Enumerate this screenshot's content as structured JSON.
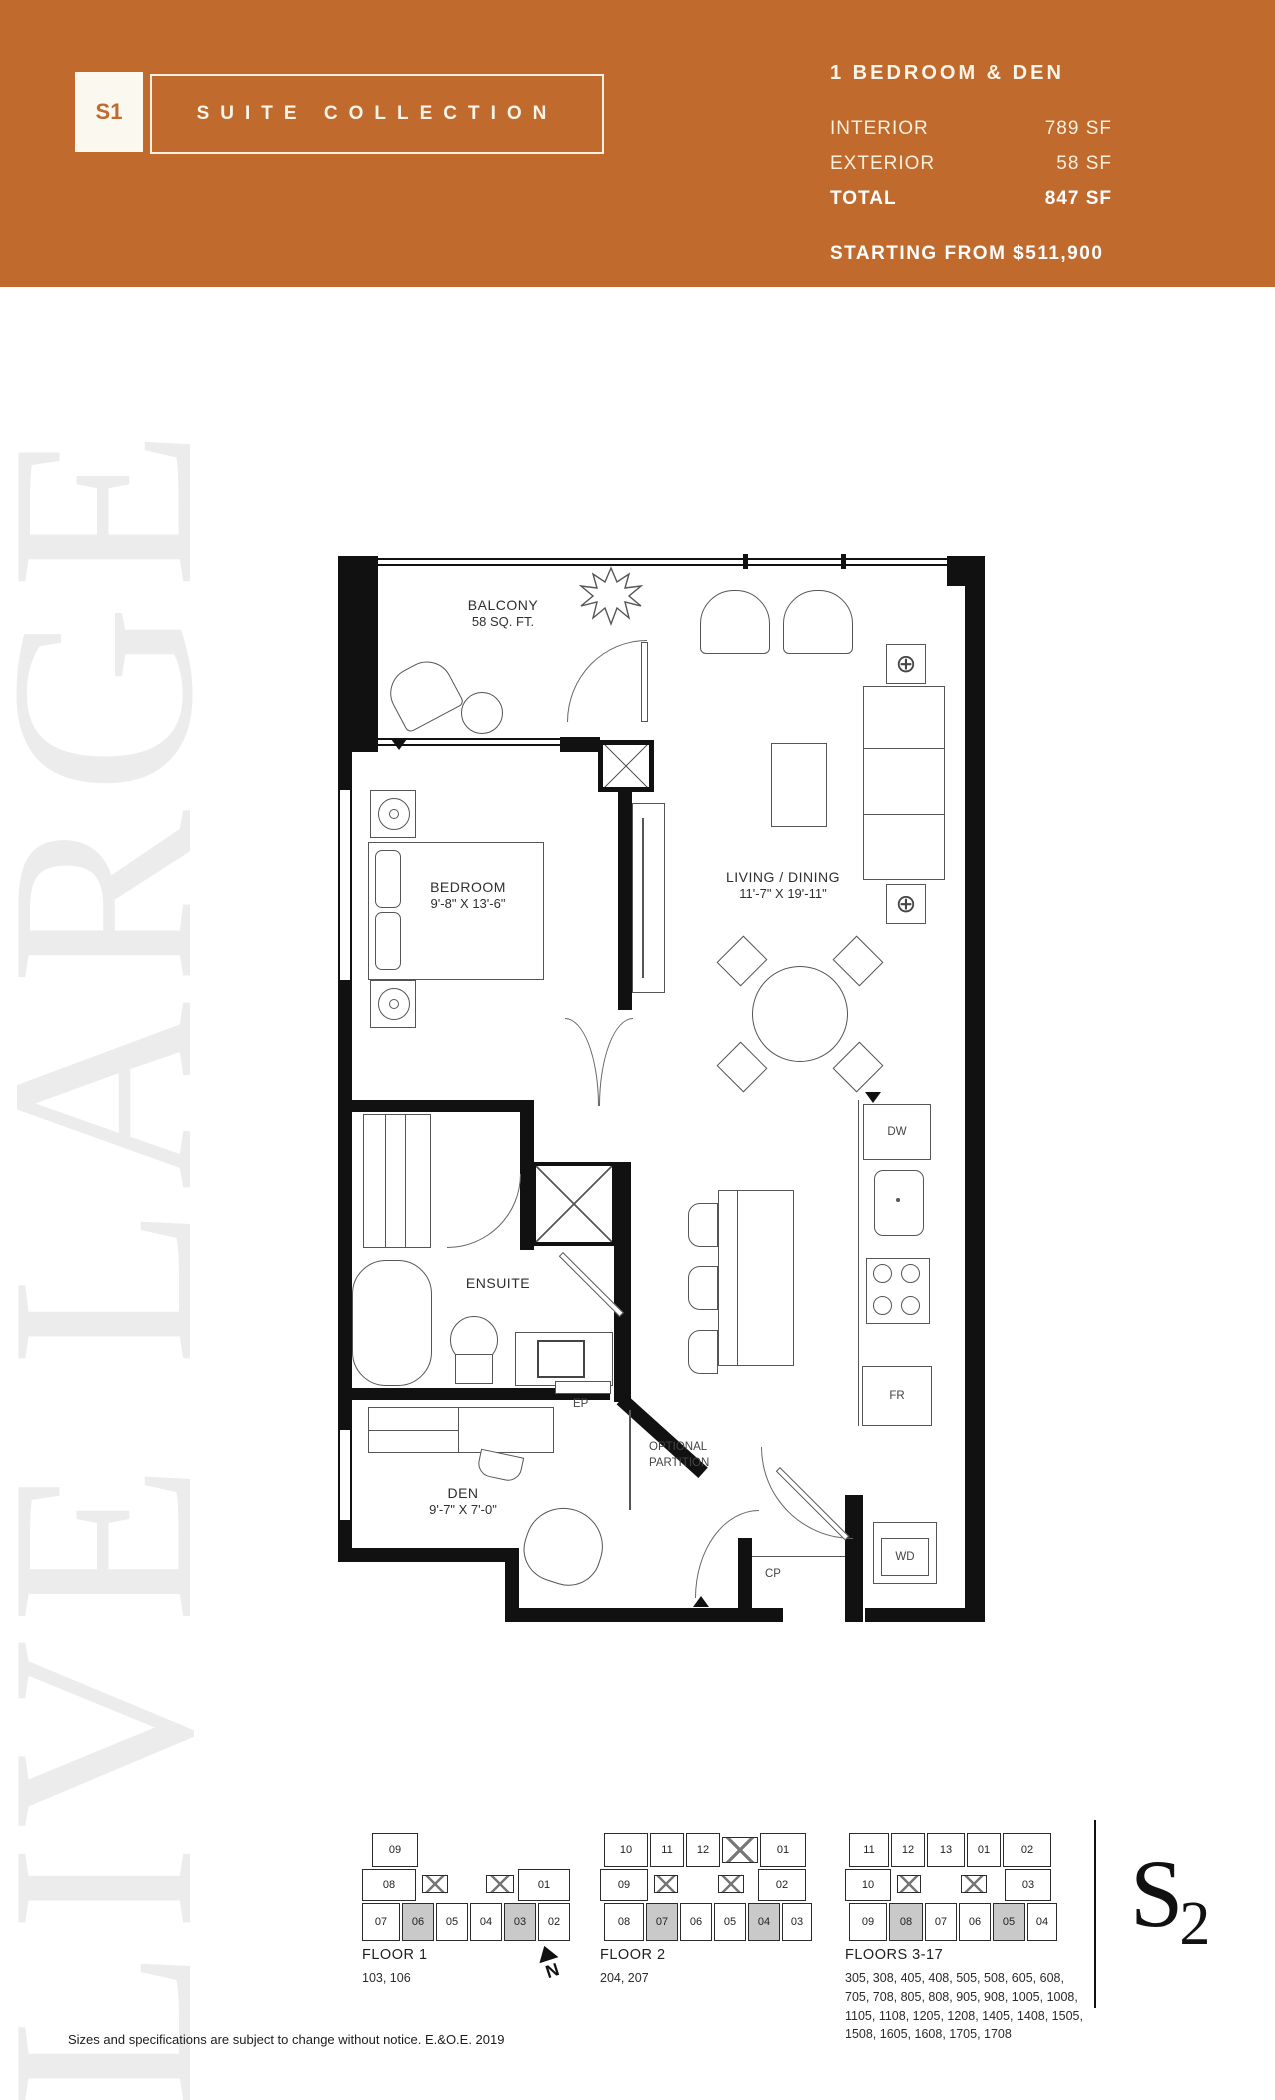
{
  "header": {
    "suite_code": "S1",
    "collection_label": "SUITE COLLECTION",
    "plan_type": "1 BEDROOM & DEN",
    "stats": [
      {
        "label": "INTERIOR",
        "value": "789 SF"
      },
      {
        "label": "EXTERIOR",
        "value": "58 SF"
      },
      {
        "label": "TOTAL",
        "value": "847 SF"
      }
    ],
    "price_line": "STARTING FROM $511,900",
    "accent_color": "#c06a2e"
  },
  "watermark": "LIVE LARGE",
  "plan": {
    "balcony": {
      "name": "BALCONY",
      "area": "58 SQ. FT."
    },
    "bedroom": {
      "name": "BEDROOM",
      "dims": "9'-8\" X 13'-6\""
    },
    "living": {
      "name": "LIVING / DINING",
      "dims": "11'-7\" X 19'-11\""
    },
    "ensuite": {
      "name": "ENSUITE"
    },
    "den": {
      "name": "DEN",
      "dims": "9'-7\" X 7'-0\""
    },
    "appliances": {
      "dishwasher": "DW",
      "fridge": "FR",
      "washer_dryer": "WD",
      "coat_closet": "CP",
      "electrical_panel": "EP"
    },
    "partition_note_line1": "OPTIONAL",
    "partition_note_line2": "PARTITION"
  },
  "icons": {
    "table_lamp": "⊕"
  },
  "keyplans": [
    {
      "title": "FLOOR 1",
      "units": "103, 106",
      "top": [
        "09"
      ],
      "mid": [
        "08",
        "01"
      ],
      "bottom": [
        "07",
        "06",
        "05",
        "04",
        "03",
        "02"
      ]
    },
    {
      "title": "FLOOR 2",
      "units": "204, 207",
      "top": [
        "10",
        "11",
        "12",
        "01"
      ],
      "mid": [
        "09",
        "02"
      ],
      "bottom": [
        "08",
        "07",
        "06",
        "05",
        "04",
        "03"
      ]
    },
    {
      "title": "FLOORS 3-17",
      "units": "305, 308, 405, 408, 505, 508, 605, 608, 705, 708, 805, 808, 905, 908, 1005, 1008, 1105, 1108, 1205, 1208, 1405, 1408, 1505, 1508, 1605, 1608, 1705, 1708",
      "top": [
        "11",
        "12",
        "13",
        "01",
        "02"
      ],
      "mid": [
        "10",
        "03"
      ],
      "bottom": [
        "09",
        "08",
        "07",
        "06",
        "05",
        "04"
      ]
    }
  ],
  "north_label": "N",
  "logo": {
    "main": "S",
    "sub": "2"
  },
  "disclaimer": "Sizes and specifications are subject to change without notice. E.&O.E. 2019"
}
